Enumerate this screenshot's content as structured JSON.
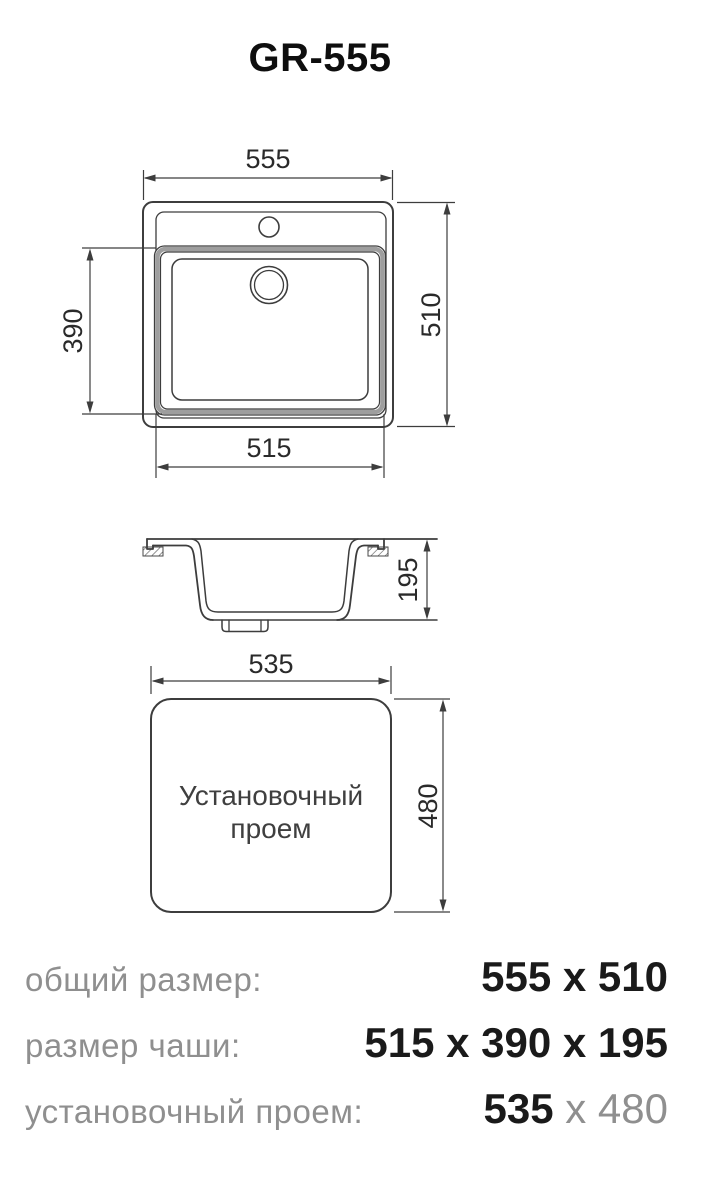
{
  "title": "GR-555",
  "colors": {
    "line": "#3d3d3d",
    "band_gray": "#9e9e9e",
    "label_gray": "#8f8f8f",
    "value_black": "#1a1a1a"
  },
  "top_view": {
    "overall_width": "555",
    "overall_height": "510",
    "bowl_length": "390",
    "bowl_width": "515"
  },
  "section_view": {
    "bowl_depth": "195"
  },
  "cutout_view": {
    "cutout_width": "535",
    "cutout_height": "480",
    "caption_line1": "Установочный",
    "caption_line2": "проем"
  },
  "summary": {
    "rows": [
      {
        "label": "общий размер:",
        "value_black": "555 x 510",
        "value_gray": ""
      },
      {
        "label": "размер чаши:",
        "value_black": "515 x 390 x 195",
        "value_gray": ""
      },
      {
        "label": "установочный проем:",
        "value_black": "535",
        "value_gray": " x 480"
      }
    ]
  }
}
